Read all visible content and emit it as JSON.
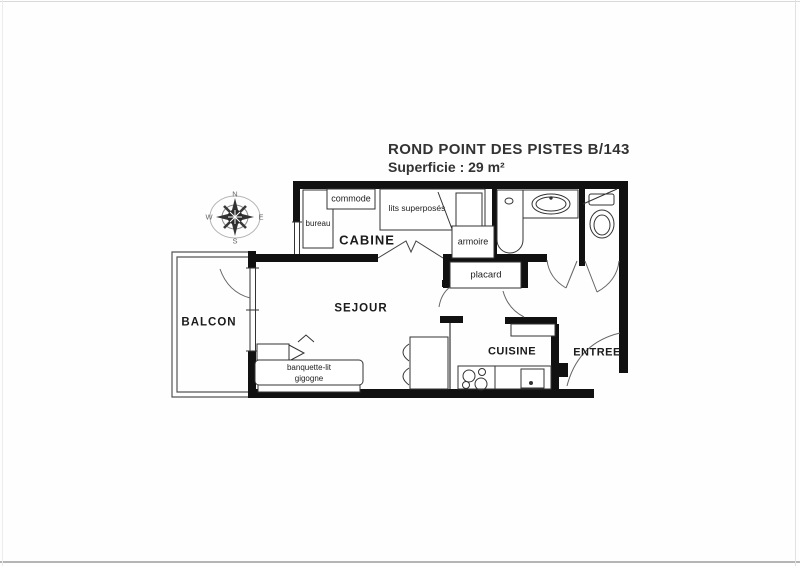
{
  "title": {
    "line1": "ROND POINT DES PISTES B/143",
    "line2": "Superficie : 29 m²"
  },
  "compass": {
    "n": "N",
    "e": "E",
    "s": "S",
    "w": "W"
  },
  "rooms": {
    "cabine": "CABINE",
    "sejour": "SEJOUR",
    "balcon": "BALCON",
    "cuisine": "CUISINE",
    "entree": "ENTREE"
  },
  "furniture": {
    "bureau": "bureau",
    "commode": "commode",
    "bunk_beds": "lits superposés",
    "armoire": "armoire",
    "placard": "placard",
    "sofa_bed_line1": "banquette-lit",
    "sofa_bed_line2": "gigogne"
  },
  "colors": {
    "ink": "#1b1b1b",
    "wall": "#111111",
    "paper": "#fefefe",
    "compass_gray": "#8a8a8a"
  }
}
